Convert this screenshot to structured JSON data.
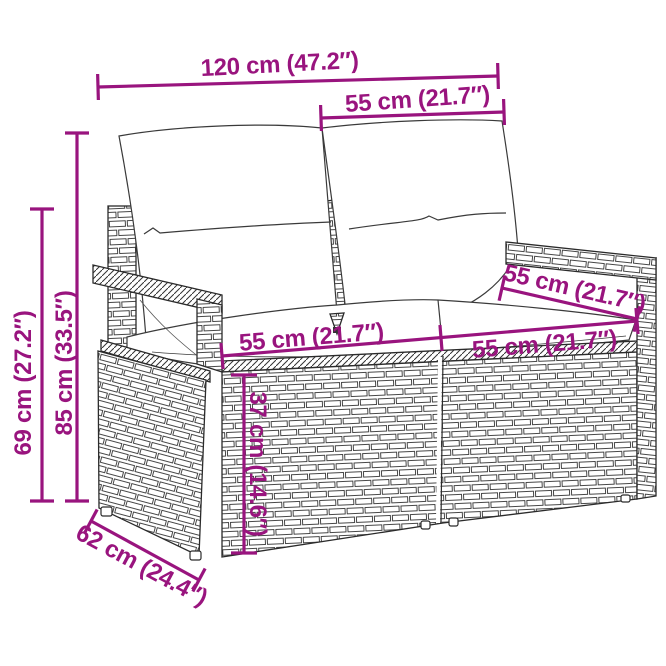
{
  "diagram": {
    "type": "product-dimension-diagram",
    "subject": "rattan-garden-loveseat-with-cushions",
    "colors": {
      "dimension": "#99147E",
      "outline": "#2b2b2b",
      "background": "#ffffff"
    },
    "labels": {
      "total_width": "120 cm (47.2″)",
      "back_cushion_width": "55 cm (21.7″)",
      "total_height": "85 cm (33.5″)",
      "armrest_height": "69 cm (27.2″)",
      "seat_depth": "55 cm (21.7″)",
      "seat_width_left": "55 cm (21.7″)",
      "seat_width_right": "55 cm (21.7″)",
      "seat_height": "37 cm (14.6″)",
      "base_depth": "62 cm (24.4″)"
    }
  }
}
